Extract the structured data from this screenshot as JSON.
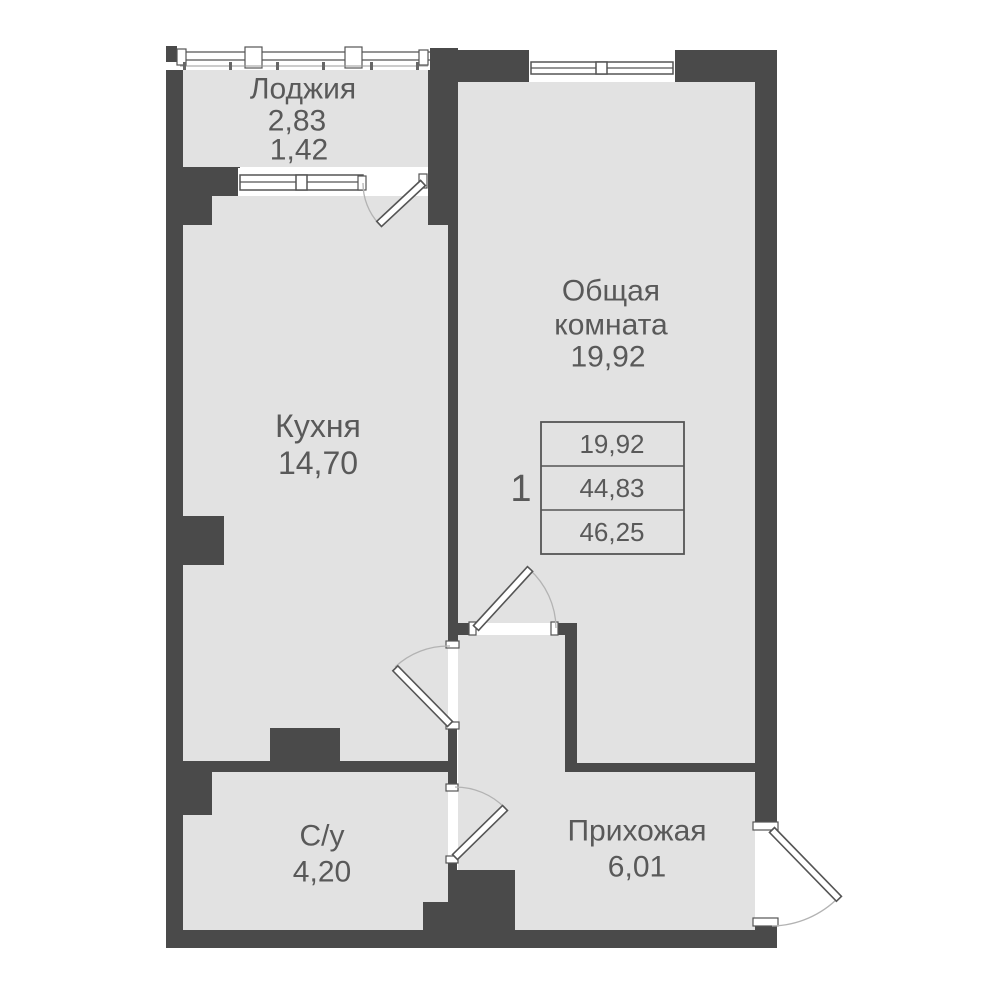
{
  "plan": {
    "rooms": {
      "loggia": {
        "label": "Лоджия",
        "area": "2,83",
        "area_coeff": "1,42"
      },
      "kitchen": {
        "label": "Кухня",
        "area": "14,70"
      },
      "living_room": {
        "label_line1": "Общая",
        "label_line2": "комната",
        "area": "19,92"
      },
      "bathroom": {
        "label": "С/у",
        "area": "4,20"
      },
      "hallway": {
        "label": "Прихожая",
        "area": "6,01"
      }
    },
    "summary_table": {
      "rooms_count": "1",
      "living_area": "19,92",
      "area_without_loggia": "44,83",
      "total_area": "46,25"
    },
    "colors": {
      "wall": "#4a4a4a",
      "room_fill": "#e2e2e2",
      "text": "#595959",
      "door_arc": "#b3b3b3",
      "background": "#ffffff"
    }
  }
}
